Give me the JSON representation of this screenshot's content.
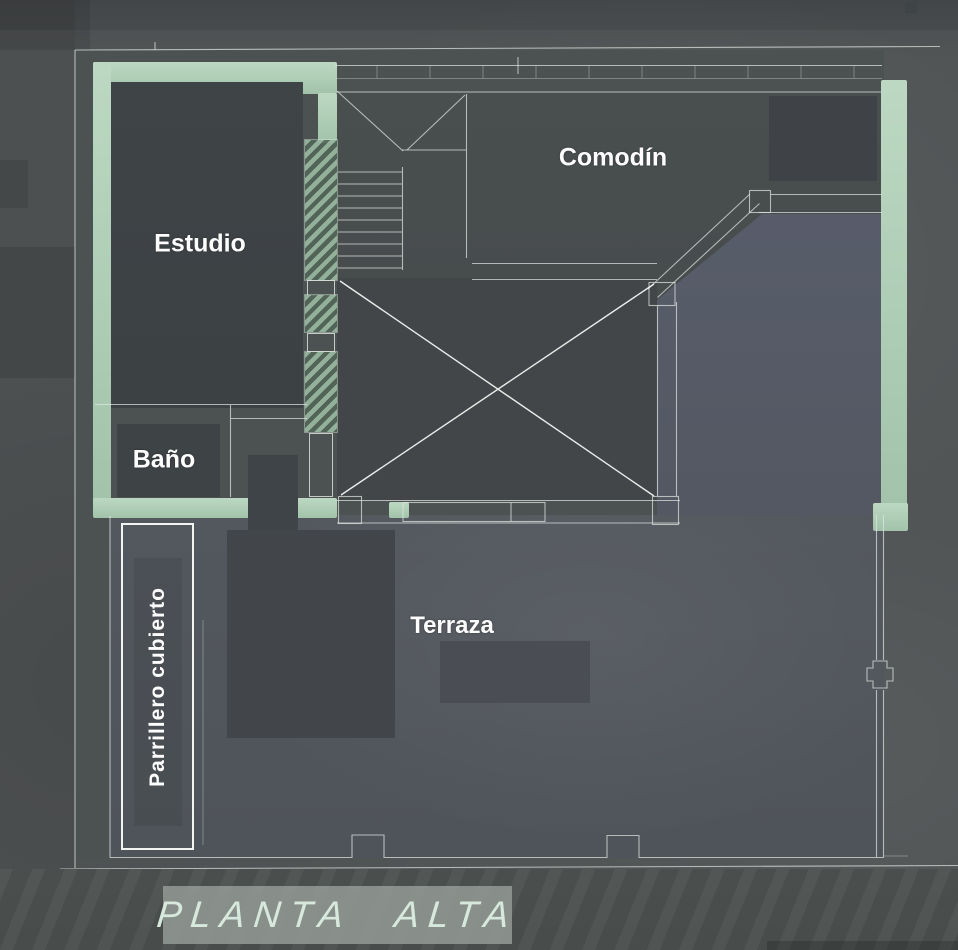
{
  "plan": {
    "title": "PLANTA ALTA",
    "rooms": {
      "estudio": "Estudio",
      "bano": "Baño",
      "comodin": "Comodín",
      "terraza": "Terraza",
      "parrillero": "Parrillero cubierto"
    },
    "colors": {
      "background": "#515556",
      "wall_green": "#aecdb5",
      "line_white": "#dfe5e0",
      "x_marker_white": "#f4f7f3",
      "redaction_dark": "#3e4346",
      "void_fill": "#404446",
      "bay_region_blue": "#555a67",
      "terrace_fill": "#52565d",
      "banner_bg": "#969e99",
      "banner_text": "#d7e9dd",
      "label_text": "#fdfdfd"
    }
  }
}
